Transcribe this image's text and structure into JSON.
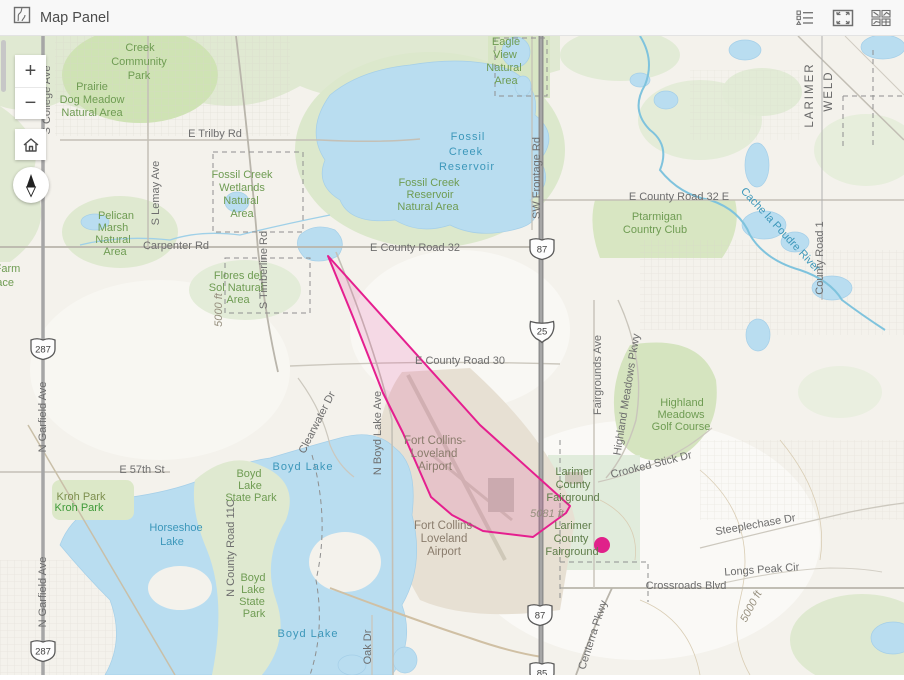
{
  "header": {
    "title": "Map Panel"
  },
  "controls": {
    "zoom_in": "+",
    "zoom_out": "−"
  },
  "map": {
    "overlay": {
      "stroke": "#e51f8f",
      "fill": "rgba(229,31,143,0.14)",
      "polygon_points": "328,256 480,425 570,506 566,513 533,537 483,531 452,515 431,497 403,433 383,393 353,317",
      "dot": {
        "x": 602,
        "y": 545,
        "r": 8,
        "color": "#e0218a"
      }
    },
    "shields": [
      {
        "t": "287",
        "x": 43,
        "y": 349,
        "k": "us"
      },
      {
        "t": "287",
        "x": 43,
        "y": 651,
        "k": "us"
      },
      {
        "t": "87",
        "x": 542,
        "y": 249,
        "k": "us"
      },
      {
        "t": "87",
        "x": 540,
        "y": 615,
        "k": "us"
      },
      {
        "t": "85",
        "x": 542,
        "y": 673,
        "k": "us"
      },
      {
        "t": "25",
        "x": 542,
        "y": 331,
        "k": "i"
      }
    ],
    "labels": [
      {
        "t": "E Trilby Rd",
        "x": 215,
        "y": 137
      },
      {
        "t": "Carpenter Rd",
        "x": 176,
        "y": 249
      },
      {
        "t": "E County Road 32",
        "x": 415,
        "y": 251
      },
      {
        "t": "E County Road 32 E",
        "x": 679,
        "y": 200
      },
      {
        "t": "E County Road 30",
        "x": 460,
        "y": 364
      },
      {
        "t": "E 57th St",
        "x": 142,
        "y": 473
      },
      {
        "t": "Crossroads Blvd",
        "x": 686,
        "y": 589
      },
      {
        "t": "Longs Peak Cir",
        "x": 762,
        "y": 573,
        "r": -4
      },
      {
        "t": "Steeplechase Dr",
        "x": 756,
        "y": 528,
        "r": -10
      },
      {
        "t": "Crooked Stick Dr",
        "x": 652,
        "y": 468,
        "r": -14
      },
      {
        "t": "S Lemay Ave",
        "x": 159,
        "y": 193,
        "r": -90
      },
      {
        "t": "S Timberline Rd",
        "x": 267,
        "y": 270,
        "r": -90
      },
      {
        "t": "S College Ave",
        "x": 50,
        "y": 100,
        "r": -90
      },
      {
        "t": "N Garfield Ave",
        "x": 46,
        "y": 417,
        "r": -90
      },
      {
        "t": "N Garfield Ave",
        "x": 46,
        "y": 592,
        "r": -90
      },
      {
        "t": "N County Road 11C",
        "x": 234,
        "y": 548,
        "r": -90
      },
      {
        "t": "N Boyd Lake Ave",
        "x": 381,
        "y": 433,
        "r": -90
      },
      {
        "t": "SW Frontage Rd",
        "x": 540,
        "y": 178,
        "r": -90
      },
      {
        "t": "Fairgrounds Ave",
        "x": 601,
        "y": 375,
        "r": -90
      },
      {
        "t": "Highland Meadows Pkwy",
        "x": 630,
        "y": 395,
        "r": -81
      },
      {
        "t": "County Road 1",
        "x": 823,
        "y": 258,
        "r": -90
      },
      {
        "t": "Clearwater Dr",
        "x": 320,
        "y": 424,
        "r": -63
      },
      {
        "t": "Oak Dr",
        "x": 371,
        "y": 647,
        "r": -90
      },
      {
        "t": "Centerra Pkwy",
        "x": 596,
        "y": 636,
        "r": -72
      },
      {
        "t": "LARIMER",
        "x": 813,
        "y": 95,
        "r": -90,
        "c": "county",
        "ls": 2
      },
      {
        "t": "WELD",
        "x": 832,
        "y": 91,
        "r": -90,
        "c": "county",
        "ls": 2
      },
      {
        "t": "Fossil",
        "x": 468,
        "y": 140,
        "c": "water",
        "s": 13,
        "ls": 1
      },
      {
        "t": "Creek",
        "x": 466,
        "y": 155,
        "c": "water",
        "s": 13,
        "ls": 1
      },
      {
        "t": "Reservoir",
        "x": 467,
        "y": 170,
        "c": "water",
        "s": 13,
        "ls": 1
      },
      {
        "t": "Boyd Lake",
        "x": 303,
        "y": 470,
        "c": "water",
        "s": 13,
        "ls": 1
      },
      {
        "t": "Boyd Lake",
        "x": 308,
        "y": 637,
        "c": "water",
        "s": 13,
        "ls": 1
      },
      {
        "t": "Horseshoe",
        "x": 176,
        "y": 531,
        "c": "water",
        "s": 12
      },
      {
        "t": "Lake",
        "x": 172,
        "y": 545,
        "c": "water",
        "s": 12
      },
      {
        "t": "Cache la Poudre River",
        "x": 778,
        "y": 232,
        "c": "water",
        "r": 47,
        "s": 11
      },
      {
        "t": "Creek",
        "x": 140,
        "y": 51,
        "c": "park"
      },
      {
        "t": "Community",
        "x": 139,
        "y": 65,
        "c": "park"
      },
      {
        "t": "Park",
        "x": 139,
        "y": 79,
        "c": "park"
      },
      {
        "t": "Prairie",
        "x": 92,
        "y": 90,
        "c": "park"
      },
      {
        "t": "Dog Meadow",
        "x": 92,
        "y": 103,
        "c": "park"
      },
      {
        "t": "Natural Area",
        "x": 92,
        "y": 116,
        "c": "park"
      },
      {
        "t": "Eagle",
        "x": 506,
        "y": 45,
        "c": "park"
      },
      {
        "t": "View",
        "x": 505,
        "y": 58,
        "c": "park"
      },
      {
        "t": "Natural",
        "x": 504,
        "y": 71,
        "c": "park"
      },
      {
        "t": "Area",
        "x": 506,
        "y": 84,
        "c": "park"
      },
      {
        "t": "Fossil Creek",
        "x": 242,
        "y": 178,
        "c": "park"
      },
      {
        "t": "Wetlands",
        "x": 242,
        "y": 191,
        "c": "park"
      },
      {
        "t": "Natural",
        "x": 241,
        "y": 204,
        "c": "park"
      },
      {
        "t": "Area",
        "x": 242,
        "y": 217,
        "c": "park"
      },
      {
        "t": "Fossil Creek",
        "x": 429,
        "y": 186,
        "c": "park"
      },
      {
        "t": "Reservoir",
        "x": 430,
        "y": 198,
        "c": "park"
      },
      {
        "t": "Natural Area",
        "x": 428,
        "y": 210,
        "c": "park"
      },
      {
        "t": "Pelican",
        "x": 116,
        "y": 219,
        "c": "park"
      },
      {
        "t": "Marsh",
        "x": 113,
        "y": 231,
        "c": "park"
      },
      {
        "t": "Natural",
        "x": 113,
        "y": 243,
        "c": "park"
      },
      {
        "t": "Area",
        "x": 115,
        "y": 255,
        "c": "park"
      },
      {
        "t": "Flores del",
        "x": 238,
        "y": 279,
        "c": "park"
      },
      {
        "t": "Sol Natural",
        "x": 236,
        "y": 291,
        "c": "park"
      },
      {
        "t": "Area",
        "x": 238,
        "y": 303,
        "c": "park"
      },
      {
        "t": "Ptarmigan",
        "x": 657,
        "y": 220,
        "c": "park"
      },
      {
        "t": "Country Club",
        "x": 655,
        "y": 233,
        "c": "park"
      },
      {
        "t": "Highland",
        "x": 682,
        "y": 406,
        "c": "park"
      },
      {
        "t": "Meadows",
        "x": 681,
        "y": 418,
        "c": "park"
      },
      {
        "t": "Golf Course",
        "x": 681,
        "y": 430,
        "c": "park"
      },
      {
        "t": "Boyd",
        "x": 249,
        "y": 477,
        "c": "park"
      },
      {
        "t": "Lake",
        "x": 250,
        "y": 489,
        "c": "park"
      },
      {
        "t": "State Park",
        "x": 251,
        "y": 501,
        "c": "park"
      },
      {
        "t": "Boyd",
        "x": 253,
        "y": 581,
        "c": "park"
      },
      {
        "t": "Lake",
        "x": 253,
        "y": 593,
        "c": "park"
      },
      {
        "t": "State",
        "x": 252,
        "y": 605,
        "c": "park"
      },
      {
        "t": "Park",
        "x": 254,
        "y": 617,
        "c": "park"
      },
      {
        "t": "Kroh Park",
        "x": 81,
        "y": 500,
        "c": "kroh1"
      },
      {
        "t": "Kroh Park",
        "x": 79,
        "y": 511,
        "c": "kroh2"
      },
      {
        "t": "w Farm",
        "x": 2,
        "y": 272,
        "c": "park",
        "a": "start"
      },
      {
        "t": "pace",
        "x": 2,
        "y": 286,
        "c": "park",
        "a": "start"
      },
      {
        "t": "Larimer",
        "x": 574,
        "y": 475,
        "c": "parkd"
      },
      {
        "t": "County",
        "x": 573,
        "y": 488,
        "c": "parkd"
      },
      {
        "t": "Fairground",
        "x": 573,
        "y": 501,
        "c": "parkd"
      },
      {
        "t": "Larimer",
        "x": 573,
        "y": 529,
        "c": "parkd"
      },
      {
        "t": "County",
        "x": 571,
        "y": 542,
        "c": "parkd"
      },
      {
        "t": "Fairground",
        "x": 572,
        "y": 555,
        "c": "parkd"
      },
      {
        "t": "Fort Collins-",
        "x": 435,
        "y": 444,
        "c": "air"
      },
      {
        "t": "Loveland",
        "x": 434,
        "y": 457,
        "c": "air"
      },
      {
        "t": "Airport",
        "x": 435,
        "y": 470,
        "c": "air"
      },
      {
        "t": "Fort Collins-",
        "x": 445,
        "y": 529,
        "c": "air"
      },
      {
        "t": "Loveland",
        "x": 444,
        "y": 542,
        "c": "air"
      },
      {
        "t": "Airport",
        "x": 444,
        "y": 555,
        "c": "air"
      },
      {
        "t": "5081 ft",
        "x": 547,
        "y": 517,
        "c": "elev"
      },
      {
        "t": "5000 ft",
        "x": 754,
        "y": 608,
        "c": "elev",
        "r": -62
      },
      {
        "t": "5000 ft",
        "x": 222,
        "y": 310,
        "c": "elev",
        "r": -90
      }
    ]
  }
}
